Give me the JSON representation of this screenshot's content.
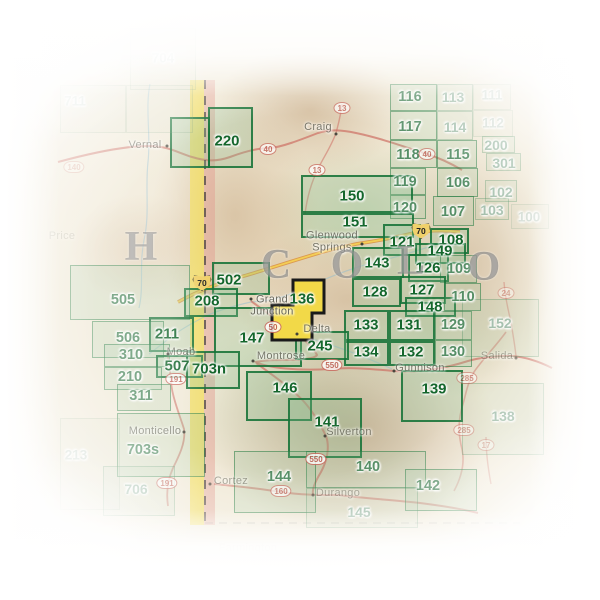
{
  "map": {
    "description": "Trails Illustrated map index grid over Colorado / eastern Utah shaded relief",
    "colors": {
      "cell_green": "#14662c",
      "highlight_fill": "#f2d948",
      "highlight_stroke": "#1a1a1a",
      "border_band_yellow": "#f2dc5f",
      "border_band_pink": "#e39a8e",
      "road_red": "#cd6f64",
      "interstate_gold": "#f0d06a",
      "river_blue": "#8fbcd0",
      "town_gray": "#5c5c50",
      "state_letter_gray": "#686868"
    },
    "state_letters": [
      {
        "char": "H",
        "x": 141,
        "y": 247
      },
      {
        "char": "C",
        "x": 276,
        "y": 265
      },
      {
        "char": "O",
        "x": 347,
        "y": 265
      },
      {
        "char": "L",
        "x": 411,
        "y": 261
      },
      {
        "char": "O",
        "x": 484,
        "y": 267
      }
    ],
    "highlighted_cell": {
      "label": "136",
      "label_x": 302,
      "label_y": 299
    },
    "cells": [
      {
        "n": "116",
        "r": [
          390,
          84,
          47,
          27
        ],
        "l": [
          410,
          97
        ],
        "t": "m"
      },
      {
        "n": "113",
        "r": [
          437,
          84,
          36,
          27
        ],
        "l": [
          453,
          97
        ],
        "t": "f"
      },
      {
        "n": "111",
        "r": [
          473,
          84,
          38,
          26
        ],
        "l": [
          492,
          95
        ],
        "t": "g"
      },
      {
        "n": "117",
        "r": [
          390,
          111,
          47,
          29
        ],
        "l": [
          410,
          127
        ],
        "t": "m"
      },
      {
        "n": "114",
        "r": [
          437,
          111,
          36,
          29
        ],
        "l": [
          455,
          127
        ],
        "t": "f"
      },
      {
        "n": "112",
        "r": [
          473,
          110,
          40,
          27
        ],
        "l": [
          493,
          123
        ],
        "t": "g"
      },
      {
        "n": "118",
        "r": [
          390,
          140,
          47,
          28
        ],
        "l": [
          408,
          155
        ],
        "t": "m"
      },
      {
        "n": "115",
        "r": [
          437,
          140,
          40,
          28
        ],
        "l": [
          458,
          155
        ],
        "t": "m"
      },
      {
        "n": "200",
        "r": [
          482,
          136,
          33,
          17
        ],
        "l": [
          496,
          145
        ],
        "t": "f"
      },
      {
        "n": "301",
        "r": [
          486,
          153,
          35,
          18
        ],
        "l": [
          504,
          163
        ],
        "t": "f"
      },
      {
        "n": "119",
        "r": [
          390,
          168,
          36,
          27
        ],
        "l": [
          405,
          182
        ],
        "t": "m"
      },
      {
        "n": "106",
        "r": [
          437,
          168,
          41,
          29
        ],
        "l": [
          458,
          183
        ],
        "t": "m"
      },
      {
        "n": "102",
        "r": [
          485,
          180,
          32,
          22
        ],
        "l": [
          501,
          192
        ],
        "t": "f"
      },
      {
        "n": "120",
        "r": [
          390,
          195,
          36,
          24
        ],
        "l": [
          405,
          208
        ],
        "t": "m"
      },
      {
        "n": "107",
        "r": [
          433,
          196,
          41,
          30
        ],
        "l": [
          453,
          212
        ],
        "t": "m"
      },
      {
        "n": "103",
        "r": [
          475,
          198,
          34,
          22
        ],
        "l": [
          492,
          210
        ],
        "t": "f"
      },
      {
        "n": "100",
        "r": [
          511,
          204,
          38,
          25
        ],
        "l": [
          529,
          217
        ],
        "t": "g"
      },
      {
        "n": "150",
        "r": [
          301,
          175,
          112,
          38
        ],
        "l": [
          352,
          196
        ],
        "t": "b"
      },
      {
        "n": "151",
        "r": [
          301,
          213,
          113,
          25
        ],
        "l": [
          355,
          222
        ],
        "t": "b"
      },
      {
        "n": "220",
        "r": [
          208,
          107,
          45,
          61
        ],
        "l": [
          227,
          141
        ],
        "t": "b"
      },
      {
        "n": "",
        "r": [
          170,
          117,
          40,
          51
        ],
        "l": null,
        "t": "b"
      },
      {
        "n": "121",
        "r": [
          383,
          224,
          38,
          32
        ],
        "l": [
          402,
          242
        ],
        "t": "b"
      },
      {
        "n": "108",
        "r": [
          430,
          228,
          39,
          26
        ],
        "l": [
          451,
          240
        ],
        "t": "b"
      },
      {
        "n": "149",
        "r": [
          415,
          243,
          51,
          21
        ],
        "l": [
          440,
          251
        ],
        "t": "b"
      },
      {
        "n": "126",
        "r": [
          408,
          254,
          41,
          28
        ],
        "l": [
          428,
          268
        ],
        "t": "b"
      },
      {
        "n": "109",
        "r": [
          440,
          255,
          37,
          28
        ],
        "l": [
          459,
          269
        ],
        "t": "m"
      },
      {
        "n": "143",
        "r": [
          352,
          247,
          52,
          31
        ],
        "l": [
          377,
          263
        ],
        "t": "b"
      },
      {
        "n": "127",
        "r": [
          400,
          276,
          46,
          28
        ],
        "l": [
          422,
          290
        ],
        "t": "b"
      },
      {
        "n": "128",
        "r": [
          352,
          278,
          49,
          29
        ],
        "l": [
          375,
          292
        ],
        "t": "b"
      },
      {
        "n": "148",
        "r": [
          405,
          297,
          51,
          20
        ],
        "l": [
          430,
          307
        ],
        "t": "b"
      },
      {
        "n": "110",
        "r": [
          444,
          283,
          37,
          28
        ],
        "l": [
          463,
          297
        ],
        "t": "m"
      },
      {
        "n": "133",
        "r": [
          344,
          310,
          45,
          31
        ],
        "l": [
          366,
          325
        ],
        "t": "b"
      },
      {
        "n": "131",
        "r": [
          389,
          310,
          46,
          31
        ],
        "l": [
          409,
          325
        ],
        "t": "b"
      },
      {
        "n": "129",
        "r": [
          435,
          311,
          37,
          29
        ],
        "l": [
          453,
          325
        ],
        "t": "m"
      },
      {
        "n": "134",
        "r": [
          344,
          341,
          45,
          25
        ],
        "l": [
          366,
          352
        ],
        "t": "b"
      },
      {
        "n": "132",
        "r": [
          389,
          341,
          46,
          25
        ],
        "l": [
          411,
          352
        ],
        "t": "b"
      },
      {
        "n": "130",
        "r": [
          435,
          340,
          37,
          27
        ],
        "l": [
          453,
          352
        ],
        "t": "m"
      },
      {
        "n": "152",
        "r": [
          462,
          299,
          77,
          58
        ],
        "l": [
          500,
          323
        ],
        "t": "f"
      },
      {
        "n": "502",
        "r": [
          212,
          262,
          58,
          33
        ],
        "l": [
          229,
          280
        ],
        "t": "b"
      },
      {
        "n": "208",
        "r": [
          184,
          288,
          54,
          29
        ],
        "l": [
          207,
          301
        ],
        "t": "b"
      },
      {
        "n": "505",
        "r": [
          70,
          265,
          120,
          55
        ],
        "l": [
          123,
          300
        ],
        "t": "m"
      },
      {
        "n": "147",
        "r": [
          214,
          307,
          88,
          60
        ],
        "l": [
          252,
          338
        ],
        "t": "b"
      },
      {
        "n": "245",
        "r": [
          295,
          331,
          54,
          29
        ],
        "l": [
          320,
          346
        ],
        "t": "b"
      },
      {
        "n": "211",
        "r": [
          149,
          317,
          45,
          35
        ],
        "l": [
          167,
          334
        ],
        "t": "b"
      },
      {
        "n": "506",
        "r": [
          92,
          321,
          72,
          37
        ],
        "l": [
          128,
          338
        ],
        "t": "m"
      },
      {
        "n": "310",
        "r": [
          104,
          344,
          66,
          23
        ],
        "l": [
          131,
          355
        ],
        "t": "m"
      },
      {
        "n": "507",
        "r": [
          156,
          355,
          47,
          23
        ],
        "l": [
          177,
          366
        ],
        "t": "b"
      },
      {
        "n": "703n",
        "r": [
          186,
          351,
          54,
          38
        ],
        "l": [
          209,
          369
        ],
        "t": "b"
      },
      {
        "n": "210",
        "r": [
          104,
          367,
          58,
          23
        ],
        "l": [
          130,
          377
        ],
        "t": "m"
      },
      {
        "n": "311",
        "r": [
          117,
          384,
          54,
          27
        ],
        "l": [
          141,
          396
        ],
        "t": "m"
      },
      {
        "n": "703s",
        "r": [
          117,
          413,
          88,
          64
        ],
        "l": [
          143,
          450
        ],
        "t": "m"
      },
      {
        "n": "706",
        "r": [
          103,
          466,
          72,
          50
        ],
        "l": [
          136,
          489
        ],
        "t": "f"
      },
      {
        "n": "146",
        "r": [
          246,
          371,
          66,
          50
        ],
        "l": [
          285,
          388
        ],
        "t": "b"
      },
      {
        "n": "141",
        "r": [
          288,
          398,
          74,
          60
        ],
        "l": [
          327,
          422
        ],
        "t": "b"
      },
      {
        "n": "139",
        "r": [
          401,
          370,
          62,
          52
        ],
        "l": [
          434,
          389
        ],
        "t": "b"
      },
      {
        "n": "140",
        "r": [
          306,
          451,
          120,
          37
        ],
        "l": [
          368,
          467
        ],
        "t": "m"
      },
      {
        "n": "144",
        "r": [
          234,
          451,
          82,
          62
        ],
        "l": [
          279,
          477
        ],
        "t": "m"
      },
      {
        "n": "142",
        "r": [
          405,
          469,
          72,
          42
        ],
        "l": [
          428,
          486
        ],
        "t": "m"
      },
      {
        "n": "145",
        "r": [
          306,
          488,
          112,
          40
        ],
        "l": [
          359,
          512
        ],
        "t": "f"
      },
      {
        "n": "138",
        "r": [
          462,
          383,
          82,
          72
        ],
        "l": [
          503,
          416
        ],
        "t": "f"
      },
      {
        "n": "711",
        "r": [
          60,
          85,
          66,
          48
        ],
        "l": [
          75,
          101
        ],
        "t": "g"
      },
      {
        "n": "",
        "r": [
          126,
          85,
          67,
          48
        ],
        "l": null,
        "t": "g"
      },
      {
        "n": "704",
        "r": [
          130,
          28,
          66,
          62
        ],
        "l": [
          163,
          58
        ],
        "t": "g"
      },
      {
        "n": "213",
        "r": [
          60,
          418,
          60,
          92
        ],
        "l": [
          76,
          455
        ],
        "t": "g"
      }
    ],
    "towns": [
      {
        "name": "Vernal",
        "x": 145,
        "y": 146,
        "dot": [
          167,
          146
        ],
        "o": 0.8
      },
      {
        "name": "Craig",
        "x": 318,
        "y": 128,
        "dot": [
          336,
          134
        ],
        "o": 0.85
      },
      {
        "name": "Glenwood\nSprings",
        "x": 332,
        "y": 242,
        "dot": [
          362,
          244
        ],
        "o": 0.9
      },
      {
        "name": "Grand\nJunction",
        "x": 272,
        "y": 306,
        "dot": [
          251,
          299
        ],
        "o": 1
      },
      {
        "name": "Delta",
        "x": 317,
        "y": 330,
        "dot": [
          297,
          334
        ],
        "o": 0.9
      },
      {
        "name": "Montrose",
        "x": 281,
        "y": 357,
        "dot": [
          253,
          361
        ],
        "o": 0.85
      },
      {
        "name": "Moab",
        "x": 181,
        "y": 353,
        "dot": [
          168,
          354
        ],
        "o": 0.8
      },
      {
        "name": "Monticello",
        "x": 155,
        "y": 432,
        "dot": [
          184,
          432
        ],
        "o": 0.8
      },
      {
        "name": "Cortez",
        "x": 231,
        "y": 482,
        "dot": [
          210,
          484
        ],
        "o": 0.6
      },
      {
        "name": "Gunnison",
        "x": 420,
        "y": 369,
        "dot": [
          394,
          371
        ],
        "o": 0.85
      },
      {
        "name": "Silverton",
        "x": 349,
        "y": 433,
        "dot": [
          325,
          436
        ],
        "o": 0.8
      },
      {
        "name": "Durango",
        "x": 338,
        "y": 494,
        "dot": [
          313,
          495
        ],
        "o": 0.55
      },
      {
        "name": "Salida",
        "x": 497,
        "y": 357,
        "dot": [
          516,
          358
        ],
        "o": 0.5
      },
      {
        "name": "Price",
        "x": 62,
        "y": 237,
        "dot": null,
        "o": 0.25
      },
      {
        "name": "Farmington",
        "x": 248,
        "y": 549,
        "dot": null,
        "o": 0.12
      }
    ],
    "shields": [
      {
        "k": "us",
        "n": "40",
        "x": 268,
        "y": 149,
        "o": 0.75
      },
      {
        "k": "us",
        "n": "40",
        "x": 427,
        "y": 154,
        "o": 0.7
      },
      {
        "k": "us",
        "n": "13",
        "x": 342,
        "y": 108,
        "o": 0.75
      },
      {
        "k": "us",
        "n": "13",
        "x": 317,
        "y": 170,
        "o": 0.75
      },
      {
        "k": "i",
        "n": "70",
        "x": 421,
        "y": 231,
        "o": 1
      },
      {
        "k": "i",
        "n": "70",
        "x": 202,
        "y": 283,
        "o": 1
      },
      {
        "k": "us",
        "n": "50",
        "x": 273,
        "y": 327,
        "o": 0.9
      },
      {
        "k": "us",
        "n": "550",
        "x": 332,
        "y": 365,
        "o": 0.85
      },
      {
        "k": "us",
        "n": "550",
        "x": 316,
        "y": 459,
        "o": 0.85
      },
      {
        "k": "us",
        "n": "160",
        "x": 281,
        "y": 491,
        "o": 0.7
      },
      {
        "k": "us",
        "n": "191",
        "x": 176,
        "y": 379,
        "o": 0.85
      },
      {
        "k": "us",
        "n": "191",
        "x": 167,
        "y": 483,
        "o": 0.75
      },
      {
        "k": "us",
        "n": "285",
        "x": 467,
        "y": 378,
        "o": 0.55
      },
      {
        "k": "us",
        "n": "285",
        "x": 464,
        "y": 430,
        "o": 0.5
      },
      {
        "k": "us",
        "n": "24",
        "x": 506,
        "y": 293,
        "o": 0.4
      },
      {
        "k": "us",
        "n": "17",
        "x": 486,
        "y": 445,
        "o": 0.4
      },
      {
        "k": "us",
        "n": "140",
        "x": 74,
        "y": 167,
        "o": 0.3
      }
    ]
  }
}
